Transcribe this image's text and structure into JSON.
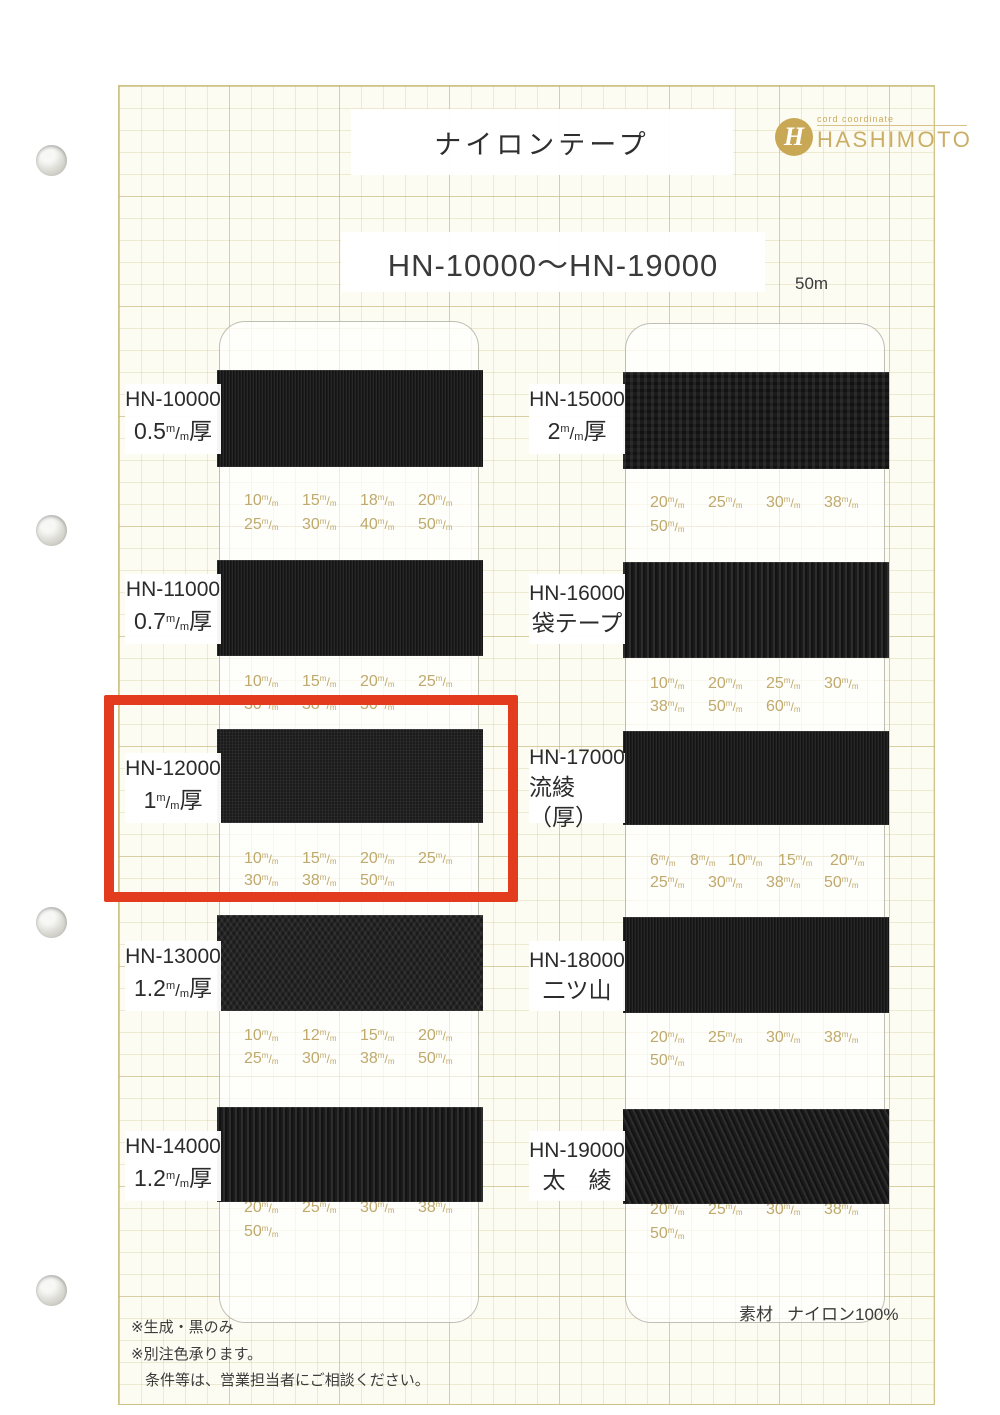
{
  "page": {
    "title": "ナイロンテープ",
    "range_heading": "HN-10000～HN-19000",
    "length_note": "50m",
    "brand": {
      "monogram": "H",
      "tagline": "cord coordinate",
      "name": "HASHIMOTO"
    },
    "footer": {
      "notes": [
        "※生成・黒のみ",
        "※別注色承ります。",
        "条件等は、営業担当者にご相談ください。"
      ],
      "material_label": "素材",
      "material_value": "ナイロン100%"
    }
  },
  "unit": {
    "top": "m",
    "bottom": "m"
  },
  "thickness_suffix": "厚",
  "highlighted_product": "HN-12000",
  "colors": {
    "highlight": "#e23b1e",
    "brand_gold": "#c9a855",
    "size_text": "#bfa96c",
    "tape": "#1b1b1b"
  },
  "columns": {
    "left": [
      {
        "code": "HN-10000",
        "spec": {
          "value": "0.5"
        },
        "texture": "rib-fine",
        "sizes": [
          [
            "10",
            "15",
            "18",
            "20"
          ],
          [
            "25",
            "30",
            "40",
            "50"
          ]
        ]
      },
      {
        "code": "HN-11000",
        "spec": {
          "value": "0.7"
        },
        "texture": "rib-fine",
        "sizes": [
          [
            "10",
            "15",
            "20",
            "25"
          ],
          [
            "30",
            "38",
            "50"
          ]
        ]
      },
      {
        "code": "HN-12000",
        "spec": {
          "value": "1"
        },
        "texture": "weave-fine",
        "sizes": [
          [
            "10",
            "15",
            "20",
            "25"
          ],
          [
            "30",
            "38",
            "50"
          ]
        ]
      },
      {
        "code": "HN-13000",
        "spec": {
          "value": "1.2"
        },
        "texture": "herringbone",
        "sizes": [
          [
            "10",
            "12",
            "15",
            "20"
          ],
          [
            "25",
            "30",
            "38",
            "50"
          ]
        ]
      },
      {
        "code": "HN-14000",
        "spec": {
          "value": "1.2"
        },
        "texture": "rib-coarse",
        "sizes": [
          [
            "20",
            "25",
            "30",
            "38"
          ],
          [
            "50"
          ]
        ]
      }
    ],
    "right": [
      {
        "code": "HN-15000",
        "spec": {
          "value": "2"
        },
        "texture": "weave-coarse",
        "sizes": [
          [
            "20",
            "25",
            "30",
            "38"
          ],
          [
            "50"
          ]
        ]
      },
      {
        "code": "HN-16000",
        "spec": {
          "text": "袋テープ"
        },
        "texture": "rib-coarse",
        "sizes": [
          [
            "10",
            "20",
            "25",
            "30"
          ],
          [
            "38",
            "50",
            "60"
          ]
        ]
      },
      {
        "code": "HN-17000",
        "spec": {
          "text": "流綾（厚）"
        },
        "texture": "rib-fine",
        "sizes": [
          [
            "6",
            "8",
            "10",
            "15",
            "20"
          ],
          [
            "25",
            "30",
            "38",
            "50"
          ]
        ]
      },
      {
        "code": "HN-18000",
        "spec": {
          "text": "二ツ山"
        },
        "texture": "rib-fine",
        "sizes": [
          [
            "20",
            "25",
            "30",
            "38"
          ],
          [
            "50"
          ]
        ]
      },
      {
        "code": "HN-19000",
        "spec": {
          "text": "太　綾"
        },
        "texture": "twill",
        "sizes": [
          [
            "20",
            "25",
            "30",
            "38"
          ],
          [
            "50"
          ]
        ]
      }
    ]
  }
}
